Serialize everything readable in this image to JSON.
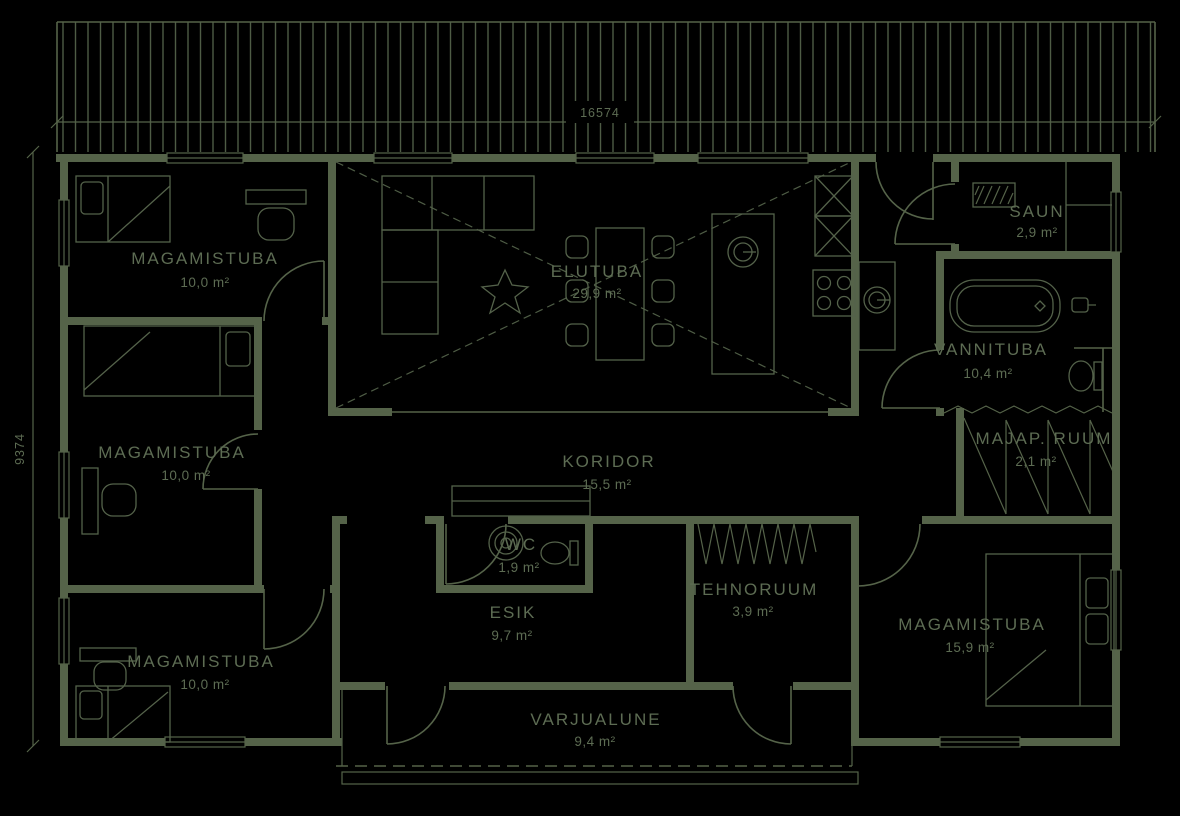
{
  "drawing": {
    "type": "floor-plan",
    "background_color": "#000000",
    "line_color": "#556349",
    "text_color": "#5d6c53"
  },
  "dimensions": {
    "top": "16574",
    "left": "9374"
  },
  "rooms": [
    {
      "id": "magamistuba-1",
      "name": "MAGAMISTUBA",
      "area": "10,0 m²"
    },
    {
      "id": "magamistuba-2",
      "name": "MAGAMISTUBA",
      "area": "10,0 m²"
    },
    {
      "id": "magamistuba-3",
      "name": "MAGAMISTUBA",
      "area": "10,0 m²"
    },
    {
      "id": "elutuba",
      "name": "ELUTUBA",
      "area": "29,9 m²"
    },
    {
      "id": "saun",
      "name": "SAUN",
      "area": "2,9 m²"
    },
    {
      "id": "vannituba",
      "name": "VANNITUBA",
      "area": "10,4 m²"
    },
    {
      "id": "majap-ruum",
      "name": "MAJAP. RUUM",
      "area": "2,1 m²"
    },
    {
      "id": "koridor",
      "name": "KORIDOR",
      "area": "15,5 m²"
    },
    {
      "id": "wc",
      "name": "WC",
      "area": "1,9 m²"
    },
    {
      "id": "esik",
      "name": "ESIK",
      "area": "9,7 m²"
    },
    {
      "id": "tehnoruum",
      "name": "TEHNORUUM",
      "area": "3,9 m²"
    },
    {
      "id": "magamistuba-4",
      "name": "MAGAMISTUBA",
      "area": "15,9 m²"
    },
    {
      "id": "varjualune",
      "name": "VARJUALUNE",
      "area": "9,4 m²"
    }
  ]
}
